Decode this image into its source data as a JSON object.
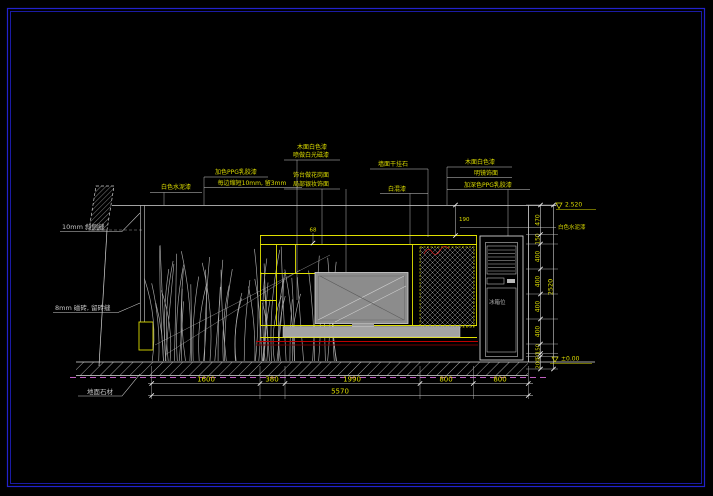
{
  "annotations": {
    "left_top": "10mm 斜侧缝",
    "left_mid": "8mm 磁砖, 留砖缝",
    "floor": "地面石材",
    "top1": "白色水泥漆",
    "top2_line1": "加色PPG乳胶漆",
    "top2_line2": "每边缩短10mm, 留3mm",
    "mid1_line1": "木面白色漆",
    "mid1_line2": "喷做白光磁漆",
    "mid2_line1": "饰台做花岗面",
    "mid2_line2": "局部银妆饰面",
    "right1_line1": "墙面干挂石",
    "right1_line2": "白混漆",
    "far1": "木面白色漆",
    "far2": "明镜饰面",
    "far3": "加深色PPG乳胶漆",
    "wall_finish_right": "白色水泥漆",
    "cabinet_text": "冰箱位"
  },
  "dims": {
    "bottom": {
      "segments": [
        "1600",
        "380",
        "1990",
        "800",
        "800"
      ],
      "total": "5570"
    },
    "right": {
      "segments": [
        "470",
        "150",
        "400",
        "400",
        "400",
        "400",
        "150",
        "50",
        "200"
      ],
      "total": "2520"
    },
    "misc": {
      "d68": "68",
      "d190": "190"
    }
  },
  "levels": {
    "top": "2.520",
    "bottom": "±0.00"
  },
  "colors": {
    "background": "#000000",
    "frame_blue": "#2222cc",
    "line_white": "#d9d9d9",
    "accent_yellow": "#dcdc00",
    "accent_red": "#b40000",
    "accent_dark_red": "#6e0000",
    "magenta": "#bf5fbf",
    "gray": "#9c9c9c"
  }
}
